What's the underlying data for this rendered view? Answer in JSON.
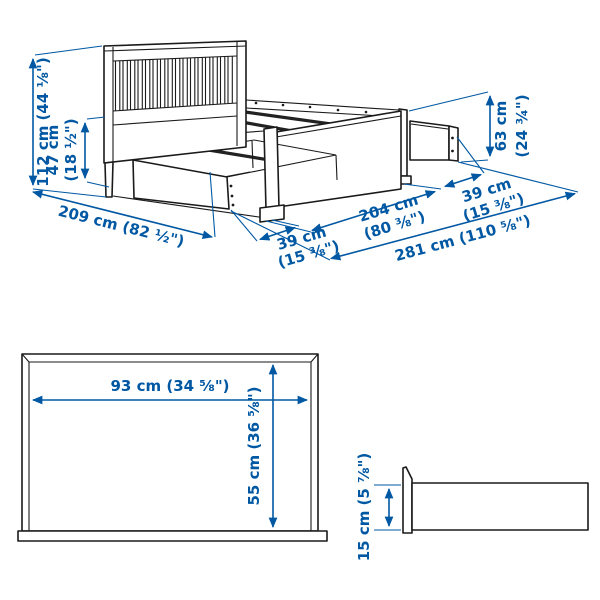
{
  "colors": {
    "dimension_blue": "#0058a3",
    "line_art": "#1a1a1a",
    "background": "#ffffff"
  },
  "bed_isometric": {
    "headboard_height": "112 cm (44 ⅛\")",
    "side_rail_height_cm": "47 cm",
    "side_rail_height_in": "(18 ½\")",
    "foot_end_height_cm": "63 cm",
    "foot_end_height_in": "(24 ¾\")",
    "total_length": "209 cm (82 ½\")",
    "front_drawer_extension_cm": "39 cm",
    "front_drawer_extension_in": "(15 ⅜\")",
    "frame_length_cm": "204 cm",
    "frame_length_in": "(80 ⅜\")",
    "foot_drawer_extension_cm": "39 cm",
    "foot_drawer_extension_in": "(15 ⅜\")",
    "total_span_drawers_open": "281 cm (110 ⅝\")"
  },
  "drawer_front_view": {
    "width": "93 cm (34 ⅝\")",
    "height": "55 cm (36 ⅝\")"
  },
  "drawer_side_view": {
    "height": "15 cm (5 ⅞\")"
  }
}
